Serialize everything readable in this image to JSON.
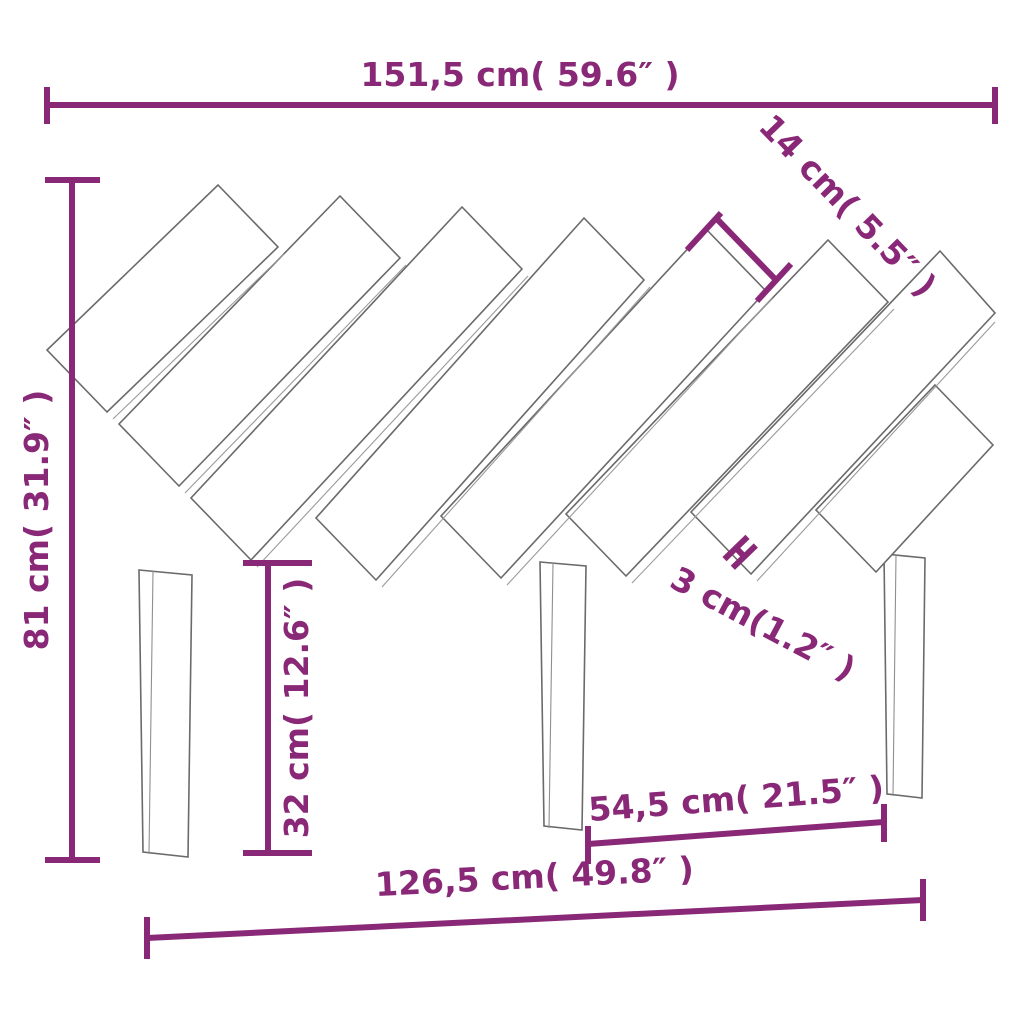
{
  "diagram": {
    "type": "furniture-dimension-diagram",
    "subject": "bed headboard with diagonal slats and three legs",
    "background_color": "#ffffff",
    "colors": {
      "dimension_annotation": "#8A2878",
      "drawing_outline": "#6a6a6a"
    },
    "elements": {
      "slat_count": 8,
      "leg_count": 3
    },
    "dimensions": {
      "overall_width": "151,5 cm( 59.6″ )",
      "slat_width": "14 cm( 5.5″ )",
      "overall_height": "81 cm( 31.9″ )",
      "leg_height": "32 cm( 12.6″ )",
      "slat_gap": "3 cm(1.2″ )",
      "leg_span": "54,5 cm( 21.5″ )",
      "base_width": "126,5 cm( 49.8″ )"
    }
  }
}
